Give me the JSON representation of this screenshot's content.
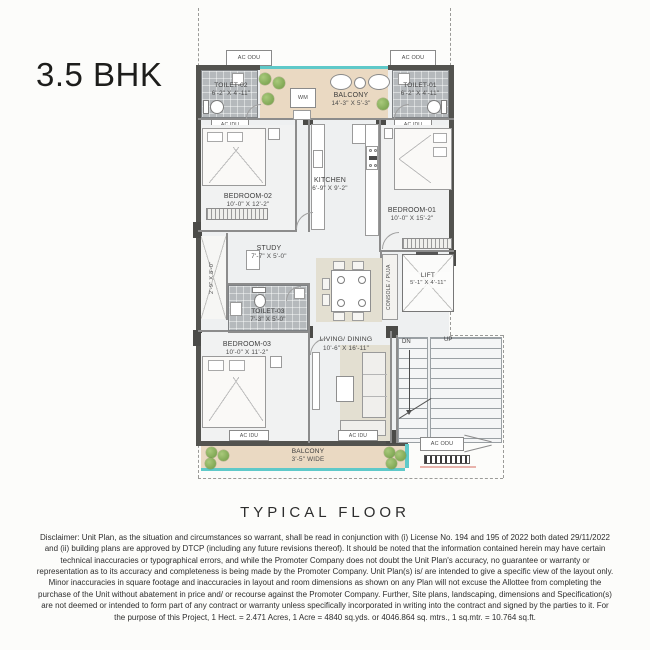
{
  "page": {
    "title": "3.5 BHK",
    "floor_caption": "TYPICAL FLOOR",
    "disclaimer": "Disclaimer: Unit Plan, as the situation and circumstances so warrant, shall be read in conjunction with (i) License No. 194 and 195 of 2022 both dated 29/11/2022 and (ii) building plans are approved by DTCP (including any future revisions thereof). It should be noted that the information contained herein may have certain technical inaccuracies or typographical errors, and while the Promoter Company does not doubt the Unit Plan's accuracy, no guarantee or warranty or representation as to its accuracy and completeness is being made by the Promoter Company. Unit Plan(s) is/ are intended to give a specific view of the layout only. Minor inaccuracies in square footage and inaccuracies in layout and room dimensions as shown on any Plan will not excuse the Allottee from completing the purchase of the Unit without abatement in price and/ or recourse against the Promoter Company. Further, Site plans, landscaping, dimensions and Specification(s) are not deemed or intended to form part of any contract or warranty unless specifically incorporated in writing into the contract and signed by the parties to it. For the purpose of this Project, 1 Hect. = 2.471 Acres, 1 Acre = 4840 sq.yds. or 4046.864 sq. mtrs., 1 sq.mtr. = 10.764 sq.ft."
  },
  "plan": {
    "rooms": {
      "toilet02": {
        "name": "TOILET-02",
        "dims": "6'-2\" X 4'-11\""
      },
      "balcony_top": {
        "name": "BALCONY",
        "dims": "14'-3\" X 5'-3\""
      },
      "toilet01": {
        "name": "TOILET-01",
        "dims": "6'-2\" X 4'-11\""
      },
      "kitchen": {
        "name": "KITCHEN",
        "dims": "6'-9\" X 9'-2\""
      },
      "bedroom02": {
        "name": "BEDROOM-02",
        "dims": "10'-0\" X 12'-2\""
      },
      "bedroom01": {
        "name": "BEDROOM-01",
        "dims": "10'-0\" X 15'-2\""
      },
      "study": {
        "name": "STUDY",
        "dims": "7'-7\" X 5'-0\""
      },
      "duct": {
        "dims": "2'-9\" X 8'-0\""
      },
      "toilet03": {
        "name": "TOILET-03",
        "dims": "7'-3\" X 5'-0\""
      },
      "console_puja": {
        "name": "CONSOLE / PUJA"
      },
      "lift": {
        "name": "LIFT",
        "dims": "5'-1\" X 4'-11\""
      },
      "bedroom03": {
        "name": "BEDROOM-03",
        "dims": "10'-0\" X 11'-2\""
      },
      "living_dining": {
        "name": "LIVING/ DINING",
        "dims": "10'-6\" X 16'-11\""
      },
      "balcony_bottom": {
        "name": "BALCONY",
        "dims": "3'-5\" WIDE"
      }
    },
    "labels": {
      "ac_odu": "AC ODU",
      "ac_idu": "AC IDU",
      "wm": "WM",
      "dn": "DN",
      "up": "UP"
    }
  }
}
